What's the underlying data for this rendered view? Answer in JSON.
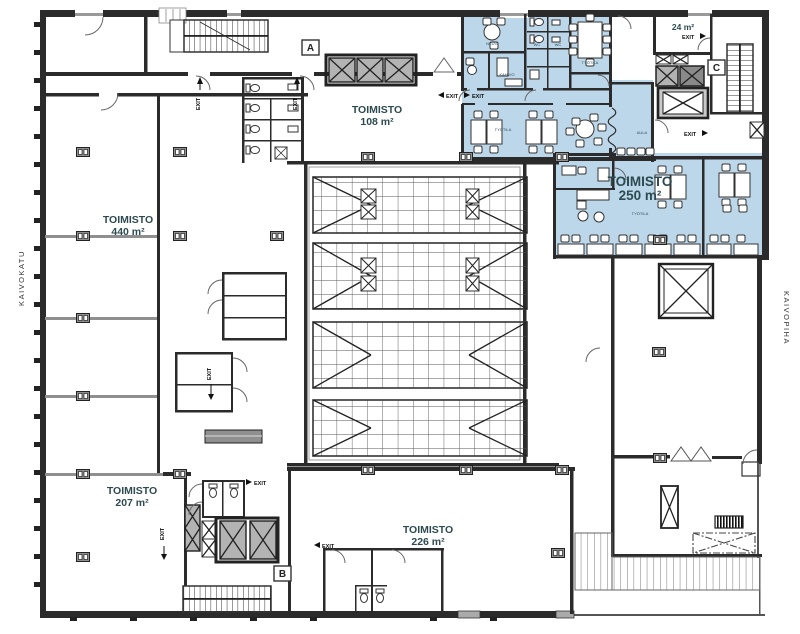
{
  "plan": {
    "streets": {
      "left": "KAIVOKATU",
      "right": "KAIVOPIHA"
    },
    "sections": {
      "a": "A",
      "b": "B",
      "c": "C"
    },
    "rooms": {
      "office440": {
        "name": "TOIMISTO",
        "area": "440 m²"
      },
      "office108": {
        "name": "TOIMISTO",
        "area": "108 m²"
      },
      "office250": {
        "name": "TOIMISTO",
        "area": "250 m²"
      },
      "office207": {
        "name": "TOIMISTO",
        "area": "207 m²"
      },
      "office226": {
        "name": "TOIMISTO",
        "area": "226 m²"
      },
      "room24": {
        "area": "24 m²"
      }
    },
    "small_labels": {
      "meeting1": "NEUV.",
      "coffee": "KAHVIO",
      "wc1": "WC",
      "wc2": "WC",
      "workspace1": "TYÖTILA",
      "workspace2": "TYÖTILA",
      "workspace3": "TYÖTILA",
      "lobby": "AULA"
    },
    "exit_label": "EXIT",
    "colors": {
      "highlight": "#bdd7ea",
      "wall": "#2b2b2b",
      "partition": "#8f8f8f",
      "elevator": "#b3b3b3",
      "label_text": "#2d4a50"
    }
  }
}
